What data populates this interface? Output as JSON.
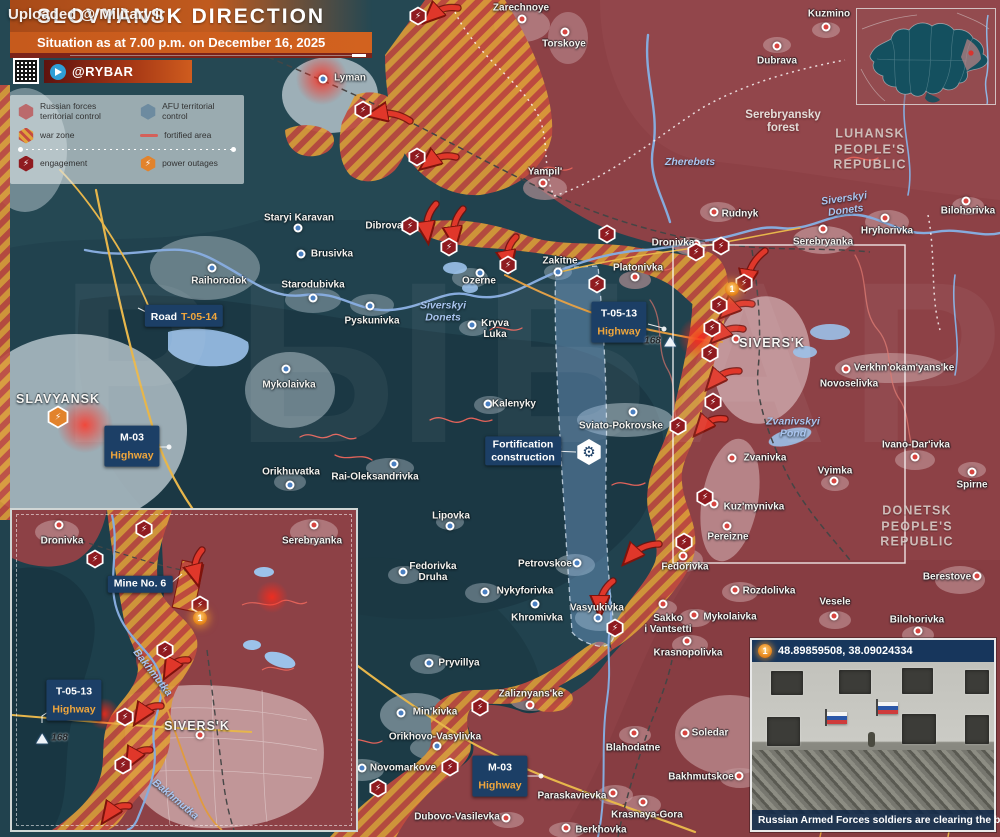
{
  "uploader_watermark": "Uploaded @ Military.ir",
  "big_watermark": "РЫБАРЬ",
  "header": {
    "title": "SLOVYANSK DIRECTION",
    "subtitle": "Situation as at 7.00 p.m. on December 16, 2025",
    "channel": "@RYBAR"
  },
  "legend": {
    "items": [
      {
        "icon": "hx-red",
        "label": "Russian forces\nterritorial control"
      },
      {
        "icon": "hx-blue",
        "label": "AFU territorial control"
      },
      {
        "icon": "hx-hatch",
        "label": "war zone"
      },
      {
        "icon": "line-red",
        "label": "fortified area"
      },
      {
        "icon": "hx-eng",
        "label": "engagement",
        "glyph": "⚡"
      },
      {
        "icon": "hx-pow",
        "label": "power outages",
        "glyph": "⚡"
      }
    ]
  },
  "map": {
    "towns": [
      {
        "n": "Zarechnoye",
        "x": 521,
        "y": 8,
        "dot": [
          1,
          11
        ],
        "c": "r"
      },
      {
        "n": "Torskoye",
        "x": 564,
        "y": 44,
        "dot": [
          1,
          -12
        ],
        "c": "r"
      },
      {
        "n": "Kuzmino",
        "x": 829,
        "y": 14,
        "dot": [
          -3,
          13
        ],
        "c": "r"
      },
      {
        "n": "Dubrava",
        "x": 777,
        "y": 61,
        "dot": [
          0,
          -15
        ],
        "c": "r"
      },
      {
        "n": "Lyman",
        "x": 350,
        "y": 78,
        "dot": [
          -27,
          1
        ],
        "c": "b"
      },
      {
        "n": "Yampil'",
        "x": 545,
        "y": 172,
        "dot": [
          -2,
          11
        ],
        "c": "r"
      },
      {
        "n": "Staryi Karavan",
        "x": 299,
        "y": 218,
        "dot": [
          -1,
          10
        ],
        "c": "b"
      },
      {
        "n": "Brusivka",
        "x": 332,
        "y": 254,
        "dot": [
          -31,
          0
        ],
        "c": "b"
      },
      {
        "n": "Raihorodok",
        "x": 219,
        "y": 281,
        "dot": [
          -7,
          -13
        ],
        "c": "b"
      },
      {
        "n": "Starodubivka",
        "x": 313,
        "y": 285,
        "dot": [
          0,
          13
        ],
        "c": "b"
      },
      {
        "n": "Pyskunivka",
        "x": 372,
        "y": 321,
        "dot": [
          -2,
          -15
        ],
        "c": "b"
      },
      {
        "n": "Mykolaivka",
        "x": 289,
        "y": 385,
        "dot": [
          -3,
          -16
        ],
        "c": "b"
      },
      {
        "n": "Dibrova",
        "x": 384,
        "y": 226
      },
      {
        "n": "Ozerne",
        "x": 479,
        "y": 281,
        "dot": [
          1,
          -8
        ],
        "c": "b"
      },
      {
        "n": "Zakitne",
        "x": 560,
        "y": 261,
        "dot": [
          -2,
          11
        ],
        "c": "b"
      },
      {
        "n": "Kryva\nLuka",
        "x": 495,
        "y": 329,
        "dot": [
          -23,
          -4
        ],
        "c": "b"
      },
      {
        "n": "Kalenyky",
        "x": 514,
        "y": 404,
        "dot": [
          -26,
          0
        ],
        "c": "b"
      },
      {
        "n": "Sviato-Pokrovske",
        "x": 621,
        "y": 426,
        "dot": [
          12,
          -14
        ],
        "c": "b"
      },
      {
        "n": "Rai-Oleksandrivka",
        "x": 375,
        "y": 477,
        "dot": [
          19,
          -13
        ],
        "c": "b"
      },
      {
        "n": "Lipovka",
        "x": 451,
        "y": 516,
        "dot": [
          -1,
          10
        ],
        "c": "b"
      },
      {
        "n": "Orikhuvatka",
        "x": 291,
        "y": 472,
        "dot": [
          -1,
          13
        ],
        "c": "b"
      },
      {
        "n": "Fedorivka\nDruha",
        "x": 433,
        "y": 572,
        "dot": [
          -30,
          0
        ],
        "c": "b"
      },
      {
        "n": "Petrovskoe",
        "x": 545,
        "y": 564,
        "dot": [
          32,
          -1
        ],
        "c": "b"
      },
      {
        "n": "Nykyforivka",
        "x": 525,
        "y": 591,
        "dot": [
          -40,
          1
        ],
        "c": "b"
      },
      {
        "n": "Khromivka",
        "x": 537,
        "y": 618,
        "dot": [
          -2,
          -14
        ],
        "c": "b"
      },
      {
        "n": "Vasyukivka",
        "x": 597,
        "y": 608,
        "dot": [
          1,
          10
        ],
        "c": "b"
      },
      {
        "n": "Pryvillya",
        "x": 459,
        "y": 663,
        "dot": [
          -30,
          0
        ],
        "c": "b"
      },
      {
        "n": "Zaliznyans'ke",
        "x": 531,
        "y": 694,
        "dot": [
          -1,
          11
        ],
        "c": "r"
      },
      {
        "n": "Min'kivka",
        "x": 435,
        "y": 712,
        "dot": [
          -34,
          1
        ],
        "c": "b"
      },
      {
        "n": "Orikhovo-Vasylivka",
        "x": 435,
        "y": 737,
        "dot": [
          2,
          9
        ],
        "c": "b"
      },
      {
        "n": "Novomarkove",
        "x": 403,
        "y": 768,
        "dot": [
          -41,
          0
        ],
        "c": "b"
      },
      {
        "n": "Dubovo-Vasilevka",
        "x": 457,
        "y": 817,
        "dot": [
          49,
          1
        ],
        "c": "r"
      },
      {
        "n": "Berkhovka",
        "x": 601,
        "y": 830,
        "dot": [
          -35,
          -2
        ],
        "c": "r"
      },
      {
        "n": "Paraskavievka",
        "x": 572,
        "y": 796,
        "dot": [
          41,
          -3
        ],
        "c": "r"
      },
      {
        "n": "Blahodatne",
        "x": 633,
        "y": 748,
        "dot": [
          1,
          -15
        ],
        "c": "r"
      },
      {
        "n": "Krasnaya-Gora",
        "x": 647,
        "y": 815,
        "dot": [
          -4,
          -13
        ],
        "c": "r"
      },
      {
        "n": "Soledar",
        "x": 710,
        "y": 733,
        "dot": [
          -25,
          0
        ],
        "c": "r"
      },
      {
        "n": "Bakhmutskoe",
        "x": 701,
        "y": 777,
        "dot": [
          38,
          -1
        ],
        "c": "r"
      },
      {
        "n": "Rudnyk",
        "x": 740,
        "y": 214,
        "dot": [
          -26,
          -2
        ],
        "c": "r"
      },
      {
        "n": "Dronivka",
        "x": 673,
        "y": 243,
        "dot": [
          23,
          1
        ],
        "c": "r"
      },
      {
        "n": "Platonivka",
        "x": 638,
        "y": 268,
        "dot": [
          -3,
          9
        ],
        "c": "r"
      },
      {
        "n": "Serebryanka",
        "x": 823,
        "y": 242,
        "dot": [
          0,
          -13
        ],
        "c": "r"
      },
      {
        "n": "Hryhorivka",
        "x": 887,
        "y": 231,
        "dot": [
          -2,
          -13
        ],
        "c": "r"
      },
      {
        "n": "Bilohorivka",
        "x": 968,
        "y": 211,
        "dot": [
          -2,
          -10
        ],
        "c": "r"
      },
      {
        "n": "Verkhn'okam'yans'ke",
        "x": 904,
        "y": 368,
        "dot": [
          -58,
          1
        ],
        "c": "r"
      },
      {
        "n": "Novoselivka",
        "x": 849,
        "y": 384
      },
      {
        "n": "Zvanivka",
        "x": 765,
        "y": 458,
        "dot": [
          -33,
          0
        ],
        "c": "r"
      },
      {
        "n": "Kuz'mynivka",
        "x": 754,
        "y": 507,
        "dot": [
          -40,
          -3
        ],
        "c": "r"
      },
      {
        "n": "Pereizne",
        "x": 728,
        "y": 537,
        "dot": [
          -1,
          -11
        ],
        "c": "r"
      },
      {
        "n": "Fedorivka",
        "x": 685,
        "y": 567,
        "dot": [
          -2,
          -11
        ],
        "c": "r"
      },
      {
        "n": "Rozdolivka",
        "x": 769,
        "y": 591,
        "dot": [
          -34,
          -1
        ],
        "c": "r"
      },
      {
        "n": "Mykolaivka",
        "x": 730,
        "y": 617,
        "dot": [
          -36,
          -2
        ],
        "c": "r"
      },
      {
        "n": "Sakko\ni Vantsetti",
        "x": 668,
        "y": 624,
        "dot": [
          -5,
          -20
        ],
        "c": "r"
      },
      {
        "n": "Krasnopolivka",
        "x": 688,
        "y": 653,
        "dot": [
          -1,
          -12
        ],
        "c": "r"
      },
      {
        "n": "Vyimka",
        "x": 835,
        "y": 471,
        "dot": [
          -1,
          10
        ],
        "c": "r"
      },
      {
        "n": "Ivano-Dar'ivka",
        "x": 916,
        "y": 445,
        "dot": [
          -1,
          12
        ],
        "c": "r"
      },
      {
        "n": "Spirne",
        "x": 972,
        "y": 485,
        "dot": [
          0,
          -13
        ],
        "c": "r"
      },
      {
        "n": "Berestove",
        "x": 947,
        "y": 577,
        "dot": [
          30,
          -1
        ],
        "c": "r"
      },
      {
        "n": "Vesele",
        "x": 835,
        "y": 602,
        "dot": [
          -1,
          14
        ],
        "c": "r"
      },
      {
        "n": "Bilohorivka",
        "x": 917,
        "y": 620,
        "dot": [
          1,
          11
        ],
        "c": "r"
      }
    ],
    "cities": [
      {
        "n": "SLAVYANSK",
        "x": 58,
        "y": 399
      },
      {
        "n": "SIVERS'K",
        "x": 772,
        "y": 343,
        "dot": [
          -36,
          -4
        ],
        "c": "r"
      }
    ],
    "regions": [
      {
        "n": "LUHANSK\nPEOPLE'S\nREPUBLIC",
        "x": 870,
        "y": 150
      },
      {
        "n": "DONETSK\nPEOPLE'S\nREPUBLIC",
        "x": 917,
        "y": 527
      }
    ],
    "forest": [
      {
        "n": "Serebryansky\nforest",
        "x": 783,
        "y": 122
      }
    ],
    "rivers": [
      {
        "n": "Zherebets",
        "x": 690,
        "y": 163,
        "rot": 0
      },
      {
        "n": "Siverskyi\nDonets",
        "x": 845,
        "y": 205,
        "rot": -8
      },
      {
        "n": "Siverskyi\nDonets",
        "x": 443,
        "y": 312,
        "rot": 0
      },
      {
        "n": "Zvanivskyi\nPond",
        "x": 793,
        "y": 428,
        "rot": 0
      }
    ],
    "badges": [
      {
        "l1": "Road",
        "l2": "T-05-14",
        "x": 184,
        "y": 316,
        "inline": true
      },
      {
        "l1": "M-03",
        "l2": "Highway",
        "x": 132,
        "y": 446
      },
      {
        "l1": "T-05-13",
        "l2": "Highway",
        "x": 619,
        "y": 322
      },
      {
        "l1": "M-03",
        "l2": "Highway",
        "x": 500,
        "y": 776
      }
    ],
    "boxes": [
      {
        "t": "Fortification\nconstruction",
        "x": 523,
        "y": 451,
        "gear": [
          66,
          1
        ]
      }
    ],
    "heights": [
      {
        "n": "168",
        "x": 660,
        "y": 341,
        "tri": "right"
      }
    ],
    "eng_icons": [
      [
        418,
        16
      ],
      [
        363,
        110
      ],
      [
        417,
        157
      ],
      [
        410,
        226
      ],
      [
        449,
        247
      ],
      [
        508,
        265
      ],
      [
        597,
        284
      ],
      [
        607,
        234
      ],
      [
        696,
        252
      ],
      [
        721,
        246
      ],
      [
        744,
        283
      ],
      [
        719,
        305
      ],
      [
        712,
        328
      ],
      [
        710,
        353
      ],
      [
        713,
        402
      ],
      [
        678,
        426
      ],
      [
        705,
        497
      ],
      [
        684,
        542
      ],
      [
        615,
        628
      ],
      [
        480,
        707
      ],
      [
        450,
        767
      ],
      [
        378,
        788
      ]
    ],
    "pow_icons": [
      [
        58,
        417
      ]
    ],
    "num_icons": [
      {
        "n": "1",
        "x": 732,
        "y": 289
      }
    ],
    "arrows": [
      [
        458,
        8,
        431,
        16
      ],
      [
        410,
        121,
        376,
        114
      ],
      [
        456,
        157,
        428,
        163
      ],
      [
        436,
        204,
        427,
        233
      ],
      [
        463,
        209,
        454,
        238
      ],
      [
        516,
        237,
        508,
        262
      ],
      [
        765,
        251,
        747,
        281
      ],
      [
        752,
        304,
        727,
        311
      ],
      [
        743,
        329,
        718,
        336
      ],
      [
        739,
        371,
        713,
        382
      ],
      [
        725,
        419,
        701,
        428
      ],
      [
        659,
        544,
        630,
        557
      ],
      [
        613,
        581,
        600,
        607
      ]
    ]
  },
  "inset": {
    "towns": [
      {
        "n": "Dronivka",
        "x": 50,
        "y": 31,
        "dot": [
          -3,
          -16
        ],
        "c": "r"
      },
      {
        "n": "Serebryanka",
        "x": 300,
        "y": 31,
        "dot": [
          2,
          -16
        ],
        "c": "r"
      }
    ],
    "cities": [
      {
        "n": "SIVERS'K",
        "x": 185,
        "y": 216,
        "dot": [
          3,
          9
        ],
        "c": "r"
      }
    ],
    "rivers": [
      {
        "n": "Bakhmutka",
        "x": 140,
        "y": 163,
        "rot": 52
      },
      {
        "n": "Bakhmutka",
        "x": 163,
        "y": 290,
        "rot": 40
      }
    ],
    "badges": [
      {
        "l1": "T-05-13",
        "l2": "Highway",
        "x": 62,
        "y": 190
      }
    ],
    "boxes": [
      {
        "t": "Mine No. 6",
        "x": 128,
        "y": 74
      }
    ],
    "heights": [
      {
        "n": "168",
        "x": 40,
        "y": 228,
        "tri": "left"
      }
    ],
    "eng_icons": [
      [
        132,
        19
      ],
      [
        83,
        49
      ],
      [
        188,
        95
      ],
      [
        153,
        140
      ],
      [
        113,
        207
      ],
      [
        111,
        255
      ]
    ],
    "pow_icons": [],
    "num_icons": [
      {
        "n": "1",
        "x": 188,
        "y": 108
      }
    ],
    "arrows": [
      [
        190,
        40,
        184,
        66
      ],
      [
        176,
        150,
        157,
        160
      ],
      [
        149,
        196,
        128,
        206
      ],
      [
        138,
        240,
        119,
        250
      ],
      [
        117,
        296,
        96,
        305
      ]
    ]
  },
  "photo": {
    "badge": "1",
    "coords": "48.89859508, 38.09024334",
    "caption": "Russian Armed Forces soldiers are clearing the building"
  }
}
